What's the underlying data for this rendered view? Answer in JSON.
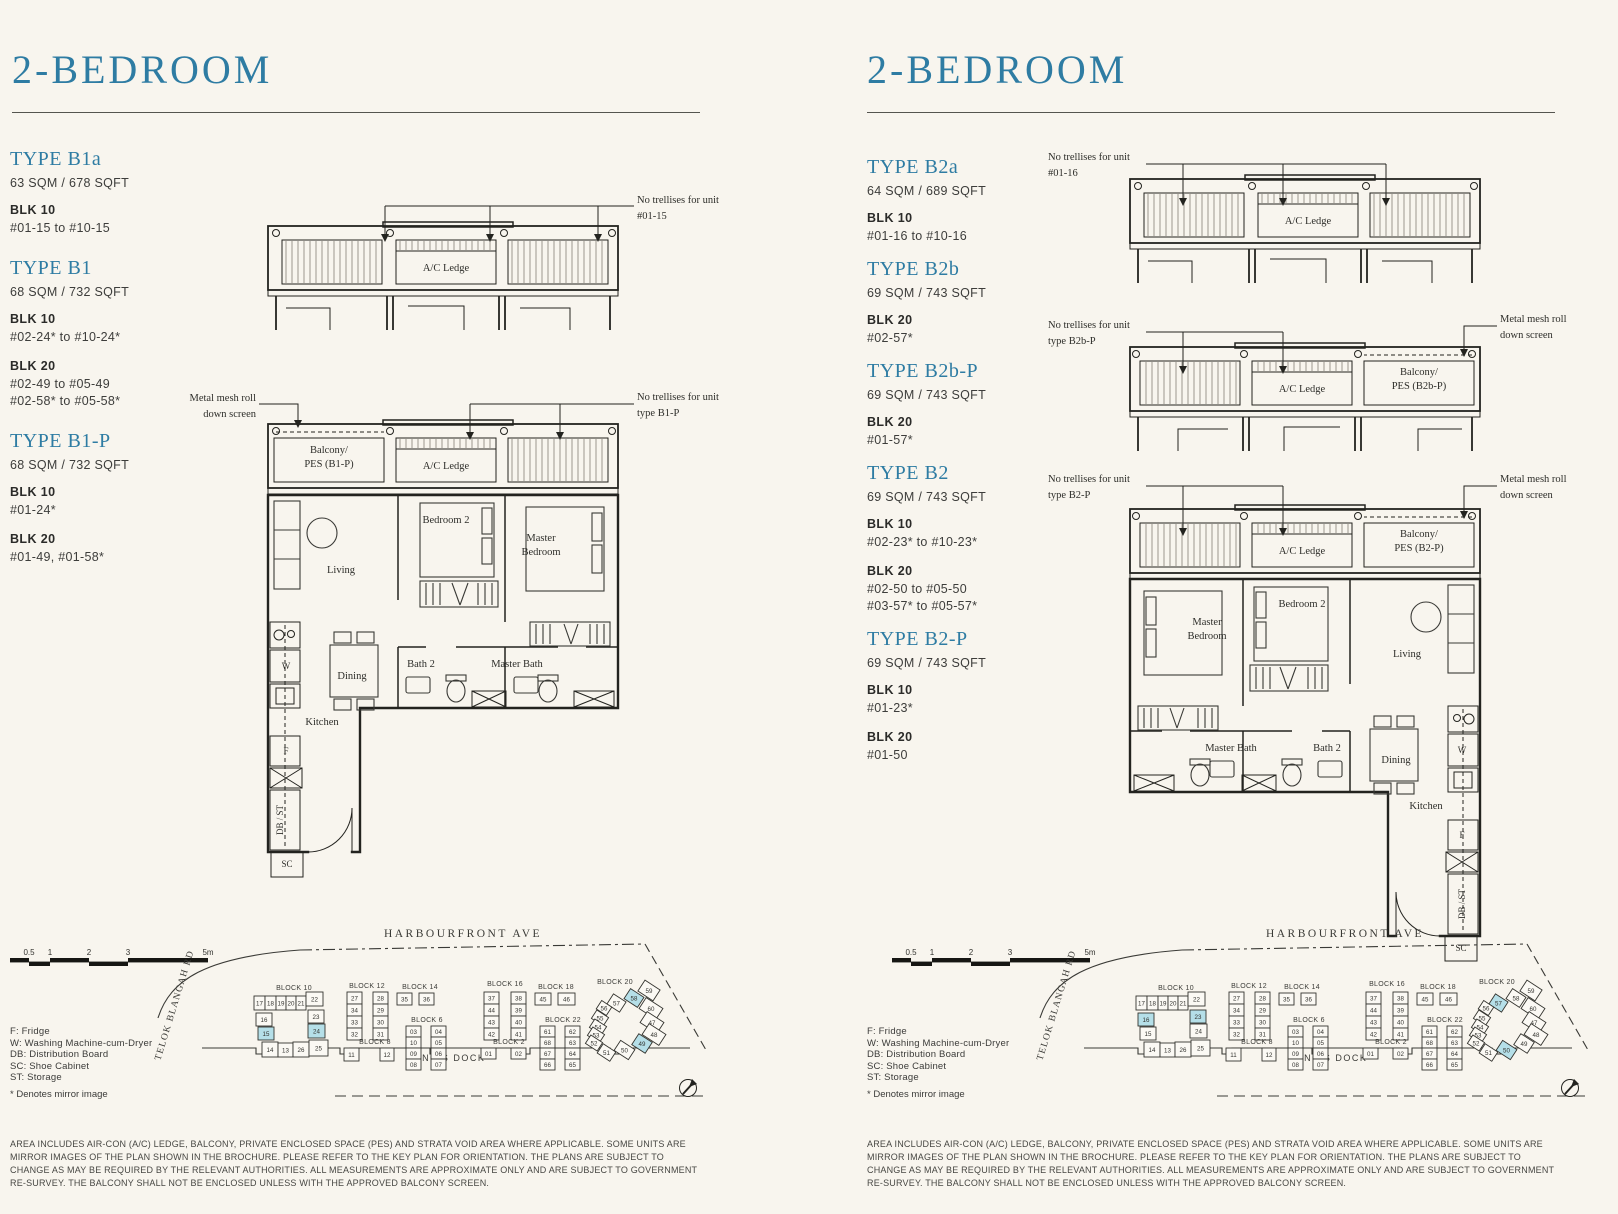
{
  "colors": {
    "paper": "#f8f5ee",
    "accent": "#2e7ca3",
    "highlight": "#b5dfe8",
    "plan_line": "#23231f",
    "trellis_hatch": "#aba79f"
  },
  "shared": {
    "header": "2-BEDROOM",
    "rooms": {
      "living": "Living",
      "bedroom2": "Bedroom 2",
      "master1": "Master",
      "master2": "Bedroom",
      "dining": "Dining",
      "kitchen": "Kitchen",
      "bath2": "Bath 2",
      "master_bath": "Master Bath",
      "w": "W",
      "f": "F",
      "dbst": "DB / ST",
      "sc": "SC",
      "ac_ledge": "A/C Ledge"
    },
    "legend": [
      "F: Fridge",
      "W: Washing Machine-cum-Dryer",
      "DB: Distribution Board",
      "SC: Shoe Cabinet",
      "ST: Storage"
    ],
    "mirror_note": "* Denotes mirror image",
    "scale_ticks": [
      "0.5",
      "1",
      "2",
      "3",
      "5m"
    ],
    "roads": {
      "top": "HARBOURFRONT AVE",
      "bottom": "KING'S DOCK",
      "left": "TELOK BLANGAH RD"
    },
    "disclaimer": "AREA INCLUDES AIR-CON (A/C) LEDGE, BALCONY, PRIVATE ENCLOSED SPACE (PES) AND STRATA VOID AREA WHERE APPLICABLE. SOME UNITS ARE MIRROR IMAGES OF THE PLAN SHOWN IN THE BROCHURE. PLEASE REFER TO THE KEY PLAN FOR ORIENTATION. THE PLANS ARE SUBJECT TO CHANGE AS MAY BE REQUIRED BY THE RELEVANT AUTHORITIES. ALL MEASUREMENTS ARE APPROXIMATE ONLY AND ARE SUBJECT TO GOVERNMENT RE-SURVEY. THE BALCONY SHALL NOT BE ENCLOSED UNLESS WITH THE APPROVED BALCONY SCREEN."
  },
  "left_page": {
    "types": [
      {
        "name": "TYPE B1a",
        "area": "63 SQM / 678 SQFT",
        "blocks": [
          {
            "blk": "BLK 10",
            "lines": [
              "#01-15 to #10-15"
            ]
          }
        ]
      },
      {
        "name": "TYPE B1",
        "area": "68 SQM / 732 SQFT",
        "blocks": [
          {
            "blk": "BLK 10",
            "lines": [
              "#02-24* to #10-24*"
            ]
          },
          {
            "blk": "BLK 20",
            "lines": [
              "#02-49 to #05-49",
              "#02-58* to #05-58*"
            ]
          }
        ]
      },
      {
        "name": "TYPE B1-P",
        "area": "68 SQM / 732 SQFT",
        "blocks": [
          {
            "blk": "BLK 10",
            "lines": [
              "#01-24*"
            ]
          },
          {
            "blk": "BLK 20",
            "lines": [
              "#01-49, #01-58*"
            ]
          }
        ]
      }
    ],
    "notes": {
      "frag_trellis_1": "No trellises for unit",
      "frag_trellis_2": "#01-15",
      "mesh_1": "Metal mesh roll",
      "mesh_2": "down screen",
      "main_trellis_1": "No trellises for unit",
      "main_trellis_2": "type B1-P"
    },
    "balcony_1": "Balcony/",
    "balcony_2": "PES (B1-P)",
    "highlight_units": [
      "15",
      "24",
      "58",
      "49"
    ]
  },
  "right_page": {
    "types": [
      {
        "name": "TYPE B2a",
        "area": "64 SQM / 689 SQFT",
        "blocks": [
          {
            "blk": "BLK 10",
            "lines": [
              "#01-16 to #10-16"
            ]
          }
        ]
      },
      {
        "name": "TYPE B2b",
        "area": "69 SQM / 743 SQFT",
        "blocks": [
          {
            "blk": "BLK 20",
            "lines": [
              "#02-57*"
            ]
          }
        ]
      },
      {
        "name": "TYPE B2b-P",
        "area": "69 SQM / 743 SQFT",
        "blocks": [
          {
            "blk": "BLK 20",
            "lines": [
              "#01-57*"
            ]
          }
        ]
      },
      {
        "name": "TYPE B2",
        "area": "69 SQM / 743 SQFT",
        "blocks": [
          {
            "blk": "BLK 10",
            "lines": [
              "#02-23* to #10-23*"
            ]
          },
          {
            "blk": "BLK 20",
            "lines": [
              "#02-50 to #05-50",
              "#03-57* to #05-57*"
            ]
          }
        ]
      },
      {
        "name": "TYPE B2-P",
        "area": "69 SQM / 743 SQFT",
        "blocks": [
          {
            "blk": "BLK 10",
            "lines": [
              "#01-23*"
            ]
          },
          {
            "blk": "BLK 20",
            "lines": [
              "#01-50"
            ]
          }
        ]
      }
    ],
    "notes": {
      "frag_trellis_1": "No trellises for unit",
      "frag_trellis_2": "#01-16",
      "strip2_trellis_1": "No trellises for unit",
      "strip2_trellis_2": "type B2b-P",
      "mesh_1": "Metal mesh roll",
      "mesh_2": "down screen",
      "main_trellis_1": "No trellises for unit",
      "main_trellis_2": "type B2-P"
    },
    "balcony2b_1": "Balcony/",
    "balcony2b_2": "PES (B2b-P)",
    "balcony_1": "Balcony/",
    "balcony_2": "PES (B2-P)",
    "highlight_units": [
      "16",
      "23",
      "57",
      "50"
    ]
  },
  "keyplan": {
    "blocks": [
      {
        "name": "BLOCK 10",
        "label": [
          146,
          72
        ],
        "cells": [
          [
            "17",
            106,
            78,
            11,
            14
          ],
          [
            "18",
            117,
            78,
            11,
            14
          ],
          [
            "19",
            128,
            78,
            10,
            14
          ],
          [
            "20",
            138,
            78,
            10,
            14
          ],
          [
            "21",
            148,
            78,
            10,
            14
          ],
          [
            "22",
            158,
            74,
            17,
            14
          ],
          [
            "16",
            108,
            95,
            16,
            13
          ],
          [
            "15",
            110,
            109,
            16,
            13
          ],
          [
            "23",
            160,
            92,
            16,
            13
          ],
          [
            "24",
            160,
            106,
            17,
            14
          ],
          [
            "14",
            114,
            124,
            16,
            15
          ],
          [
            "13",
            130,
            125,
            15,
            14
          ],
          [
            "26",
            145,
            124,
            16,
            15
          ],
          [
            "25",
            161,
            122,
            19,
            16
          ]
        ]
      },
      {
        "name": "BLOCK 12",
        "label": [
          219,
          70
        ],
        "cells": [
          [
            "27",
            199,
            74,
            15,
            12
          ],
          [
            "28",
            225,
            74,
            15,
            12
          ],
          [
            "34",
            199,
            86,
            15,
            12
          ],
          [
            "29",
            225,
            86,
            15,
            12
          ],
          [
            "33",
            199,
            98,
            15,
            12
          ],
          [
            "30",
            225,
            98,
            15,
            12
          ],
          [
            "32",
            199,
            110,
            15,
            12
          ],
          [
            "31",
            225,
            110,
            15,
            12
          ]
        ]
      },
      {
        "name": "BLOCK 14",
        "label": [
          272,
          71
        ],
        "cells": [
          [
            "35",
            249,
            75,
            15,
            12
          ],
          [
            "36",
            271,
            75,
            15,
            12
          ]
        ]
      },
      {
        "name": "BLOCK 16",
        "label": [
          357,
          68
        ],
        "cells": [
          [
            "37",
            336,
            74,
            15,
            12
          ],
          [
            "38",
            363,
            74,
            15,
            12
          ],
          [
            "44",
            336,
            86,
            15,
            12
          ],
          [
            "39",
            363,
            86,
            15,
            12
          ],
          [
            "43",
            336,
            98,
            15,
            12
          ],
          [
            "40",
            363,
            98,
            15,
            12
          ],
          [
            "42",
            336,
            110,
            15,
            12
          ],
          [
            "41",
            363,
            110,
            15,
            12
          ]
        ]
      },
      {
        "name": "BLOCK 18",
        "label": [
          408,
          71
        ],
        "cells": [
          [
            "45",
            387,
            75,
            16,
            12
          ],
          [
            "46",
            410,
            75,
            17,
            12
          ]
        ]
      },
      {
        "name": "BLOCK 6",
        "label": [
          279,
          104
        ],
        "cells": [
          [
            "03",
            258,
            108,
            15,
            11
          ],
          [
            "04",
            283,
            108,
            15,
            11
          ],
          [
            "10",
            258,
            119,
            15,
            11
          ],
          [
            "05",
            283,
            119,
            15,
            11
          ],
          [
            "09",
            258,
            130,
            15,
            11
          ],
          [
            "06",
            283,
            130,
            15,
            11
          ],
          [
            "08",
            258,
            141,
            15,
            11
          ],
          [
            "07",
            283,
            141,
            15,
            11
          ]
        ]
      },
      {
        "name": "BLOCK 2",
        "label": [
          361,
          126
        ],
        "cells": [
          [
            "01",
            333,
            130,
            15,
            11
          ],
          [
            "02",
            363,
            130,
            15,
            11
          ]
        ]
      },
      {
        "name": "BLOCK 8",
        "label": [
          227,
          126
        ],
        "cells": [
          [
            "11",
            196,
            130,
            15,
            13
          ],
          [
            "12",
            232,
            130,
            14,
            13
          ]
        ]
      },
      {
        "name": "BLOCK 22",
        "label": [
          415,
          104
        ],
        "cells": [
          [
            "61",
            392,
            108,
            15,
            11
          ],
          [
            "62",
            417,
            108,
            15,
            11
          ],
          [
            "68",
            392,
            119,
            15,
            11
          ],
          [
            "63",
            417,
            119,
            15,
            11
          ],
          [
            "67",
            392,
            130,
            15,
            11
          ],
          [
            "64",
            417,
            130,
            15,
            11
          ],
          [
            "66",
            392,
            141,
            15,
            11
          ],
          [
            "65",
            417,
            141,
            15,
            11
          ]
        ]
      },
      {
        "name": "BLOCK 20",
        "label": [
          467,
          66
        ],
        "rot": 33,
        "cells": [
          [
            "59",
            492,
            66,
            18,
            13
          ],
          [
            "58",
            478,
            74,
            16,
            12
          ],
          [
            "57",
            461,
            79,
            15,
            12
          ],
          [
            "60",
            493,
            84,
            20,
            13
          ],
          [
            "56",
            450,
            85,
            12,
            10
          ],
          [
            "55",
            445,
            95,
            14,
            10
          ],
          [
            "47",
            494,
            98,
            20,
            13
          ],
          [
            "54",
            443,
            104,
            14,
            10
          ],
          [
            "53",
            441,
            112,
            14,
            10
          ],
          [
            "48",
            496,
            110,
            20,
            13
          ],
          [
            "52",
            439,
            120,
            14,
            10
          ],
          [
            "49",
            486,
            119,
            16,
            13
          ],
          [
            "50",
            468,
            126,
            17,
            12
          ],
          [
            "51",
            451,
            129,
            15,
            11
          ]
        ]
      }
    ]
  }
}
